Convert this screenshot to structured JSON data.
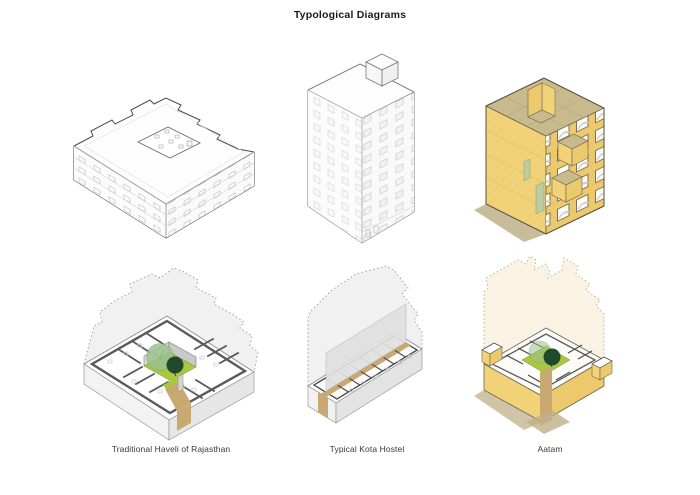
{
  "page": {
    "title": "Typological Diagrams"
  },
  "captions": [
    {
      "id": "haveli",
      "label": "Traditional Haveli of Rajasthan"
    },
    {
      "id": "hostel",
      "label": "Typical Kota Hostel"
    },
    {
      "id": "aatam",
      "label": "Aatam"
    }
  ],
  "diagrams": {
    "top_row": [
      "traditional-haveli-axonometric",
      "kota-hostel-axonometric",
      "aatam-axonometric"
    ],
    "bottom_row": [
      "traditional-haveli-ground-plan",
      "kota-hostel-ground-plan",
      "aatam-ground-plan"
    ]
  },
  "colors": {
    "facade_yellow": "#F2D278",
    "facade_yellow_dark": "#EBC96C",
    "roof_tan": "#C8BA8C",
    "path_tan": "#C9A972",
    "shadow_tan": "#BFB089",
    "courtyard_green": "#A9C83F",
    "tree_light_green": "#9CC290",
    "tree_dark_green": "#1F4A2B",
    "sage_green": "#BCCDA2",
    "wall_gray": "#5A5A5A",
    "ghost_gray": "#F1F1F1",
    "ghost_cream": "#FAF3E4",
    "ink": "#3A3A3A"
  }
}
